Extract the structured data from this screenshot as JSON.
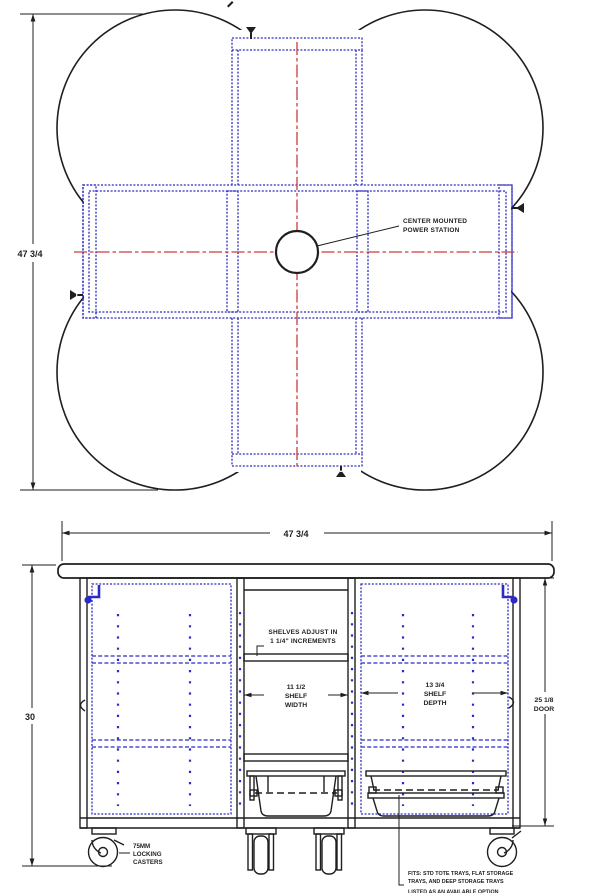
{
  "colors": {
    "line": "#1f1f1f",
    "blue": "#2b2bc4",
    "red": "#cf3a3a",
    "paper": "#ffffff"
  },
  "plan": {
    "height_dim": "47 3/4",
    "power_label": [
      "CENTER MOUNTED",
      "POWER STATION"
    ]
  },
  "front": {
    "width_dim": "47 3/4",
    "height_dim": "30",
    "shelf_note": [
      "SHELVES ADJUST IN",
      "1 1/4\" INCREMENTS"
    ],
    "shelf_width": [
      "11 1/2",
      "SHELF",
      "WIDTH"
    ],
    "shelf_depth": [
      "13 3/4",
      "SHELF",
      "DEPTH"
    ],
    "door_dim": [
      "25 1/8",
      "DOOR"
    ],
    "caster_label": [
      "75MM",
      "LOCKING",
      "CASTERS"
    ],
    "fits_note": [
      "FITS: STD TOTE TRAYS, FLAT STORAGE",
      "TRAYS, AND DEEP STORAGE TRAYS",
      "LISTED AS AN AVAILABLE OPTION"
    ]
  }
}
